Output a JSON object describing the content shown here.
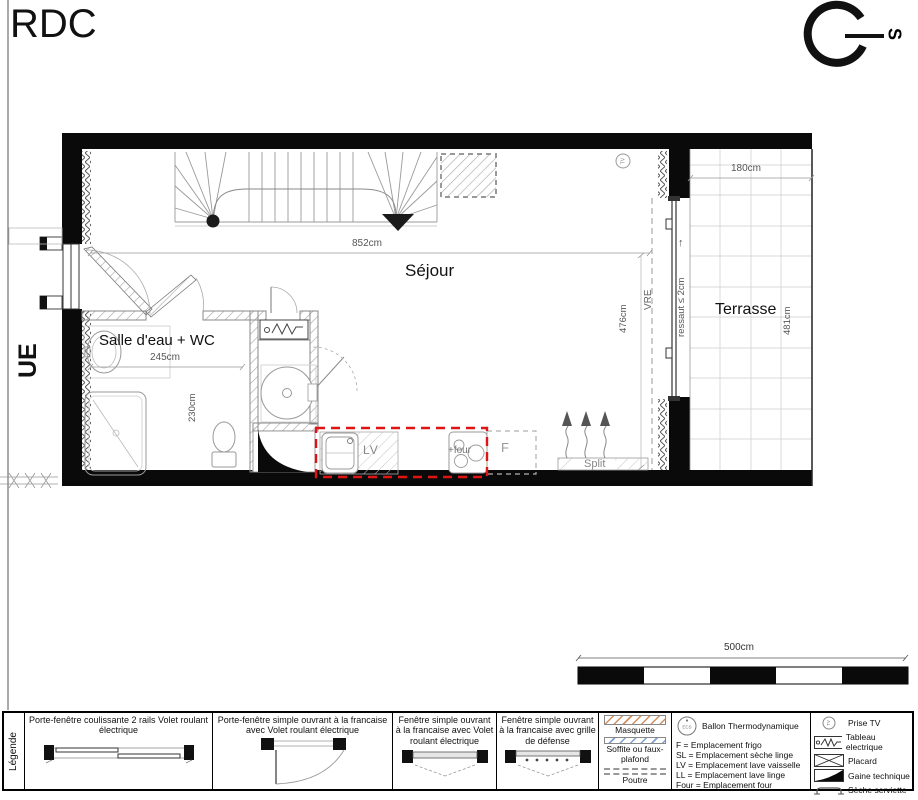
{
  "page": {
    "title": "RDC",
    "compass_south": "S"
  },
  "plan": {
    "rooms": {
      "sejour": "Séjour",
      "salle_eau_wc": "Salle d'eau + WC",
      "terrasse": "Terrasse"
    },
    "dimensions": {
      "sejour_width": "852cm",
      "salle_eau_width": "245cm",
      "salle_eau_depth": "230cm",
      "sejour_depth": "476cm",
      "terrasse_width": "180cm",
      "terrasse_depth": "481cm",
      "ressaut": "ressaut ≤ 2cm",
      "arrow_up": "↑"
    },
    "annotations": {
      "street": "UE",
      "shutter": "VRE",
      "split_unit": "Split",
      "dishwasher": "LV",
      "oven": "+four",
      "fridge": "F",
      "tv_socket": "TV"
    }
  },
  "scale_bar": {
    "label": "500cm"
  },
  "legend": {
    "title": "Légende",
    "openings": [
      {
        "label": "Porte-fenêtre coulissante 2 rails Volet roulant électrique"
      },
      {
        "label": "Porte-fenêtre simple ouvrant à la francaise avec Volet roulant électrique"
      },
      {
        "label": "Fenêtre simple ouvrant à la francaise avec Volet roulant électrique"
      },
      {
        "label": "Fenêtre simple ouvrant à la francaise avec grille de défense"
      }
    ],
    "ceiling": {
      "masquette": "Masquette",
      "soffite": "Soffite ou faux-plafond",
      "poutre": "Poutre"
    },
    "equipment": {
      "ballon": "Ballon Thermodynamique",
      "ballon_tag": "ECS",
      "lines": [
        "F = Emplacement frigo",
        "SL = Emplacement sèche linge",
        "LV = Emplacement lave vaisselle",
        "LL = Emplacement lave linge",
        "Four = Emplacement four"
      ]
    },
    "symbols": [
      {
        "label": "Prise TV"
      },
      {
        "label": "Tableau electrique"
      },
      {
        "label": "Placard"
      },
      {
        "label": "Gaine technique"
      },
      {
        "label": "Sèche serviette"
      }
    ],
    "colors": {
      "kitchen_zone_red": "#e01414",
      "masquette_hatch": "#d09060",
      "soffite_hatch": "#7f9fd0"
    }
  }
}
